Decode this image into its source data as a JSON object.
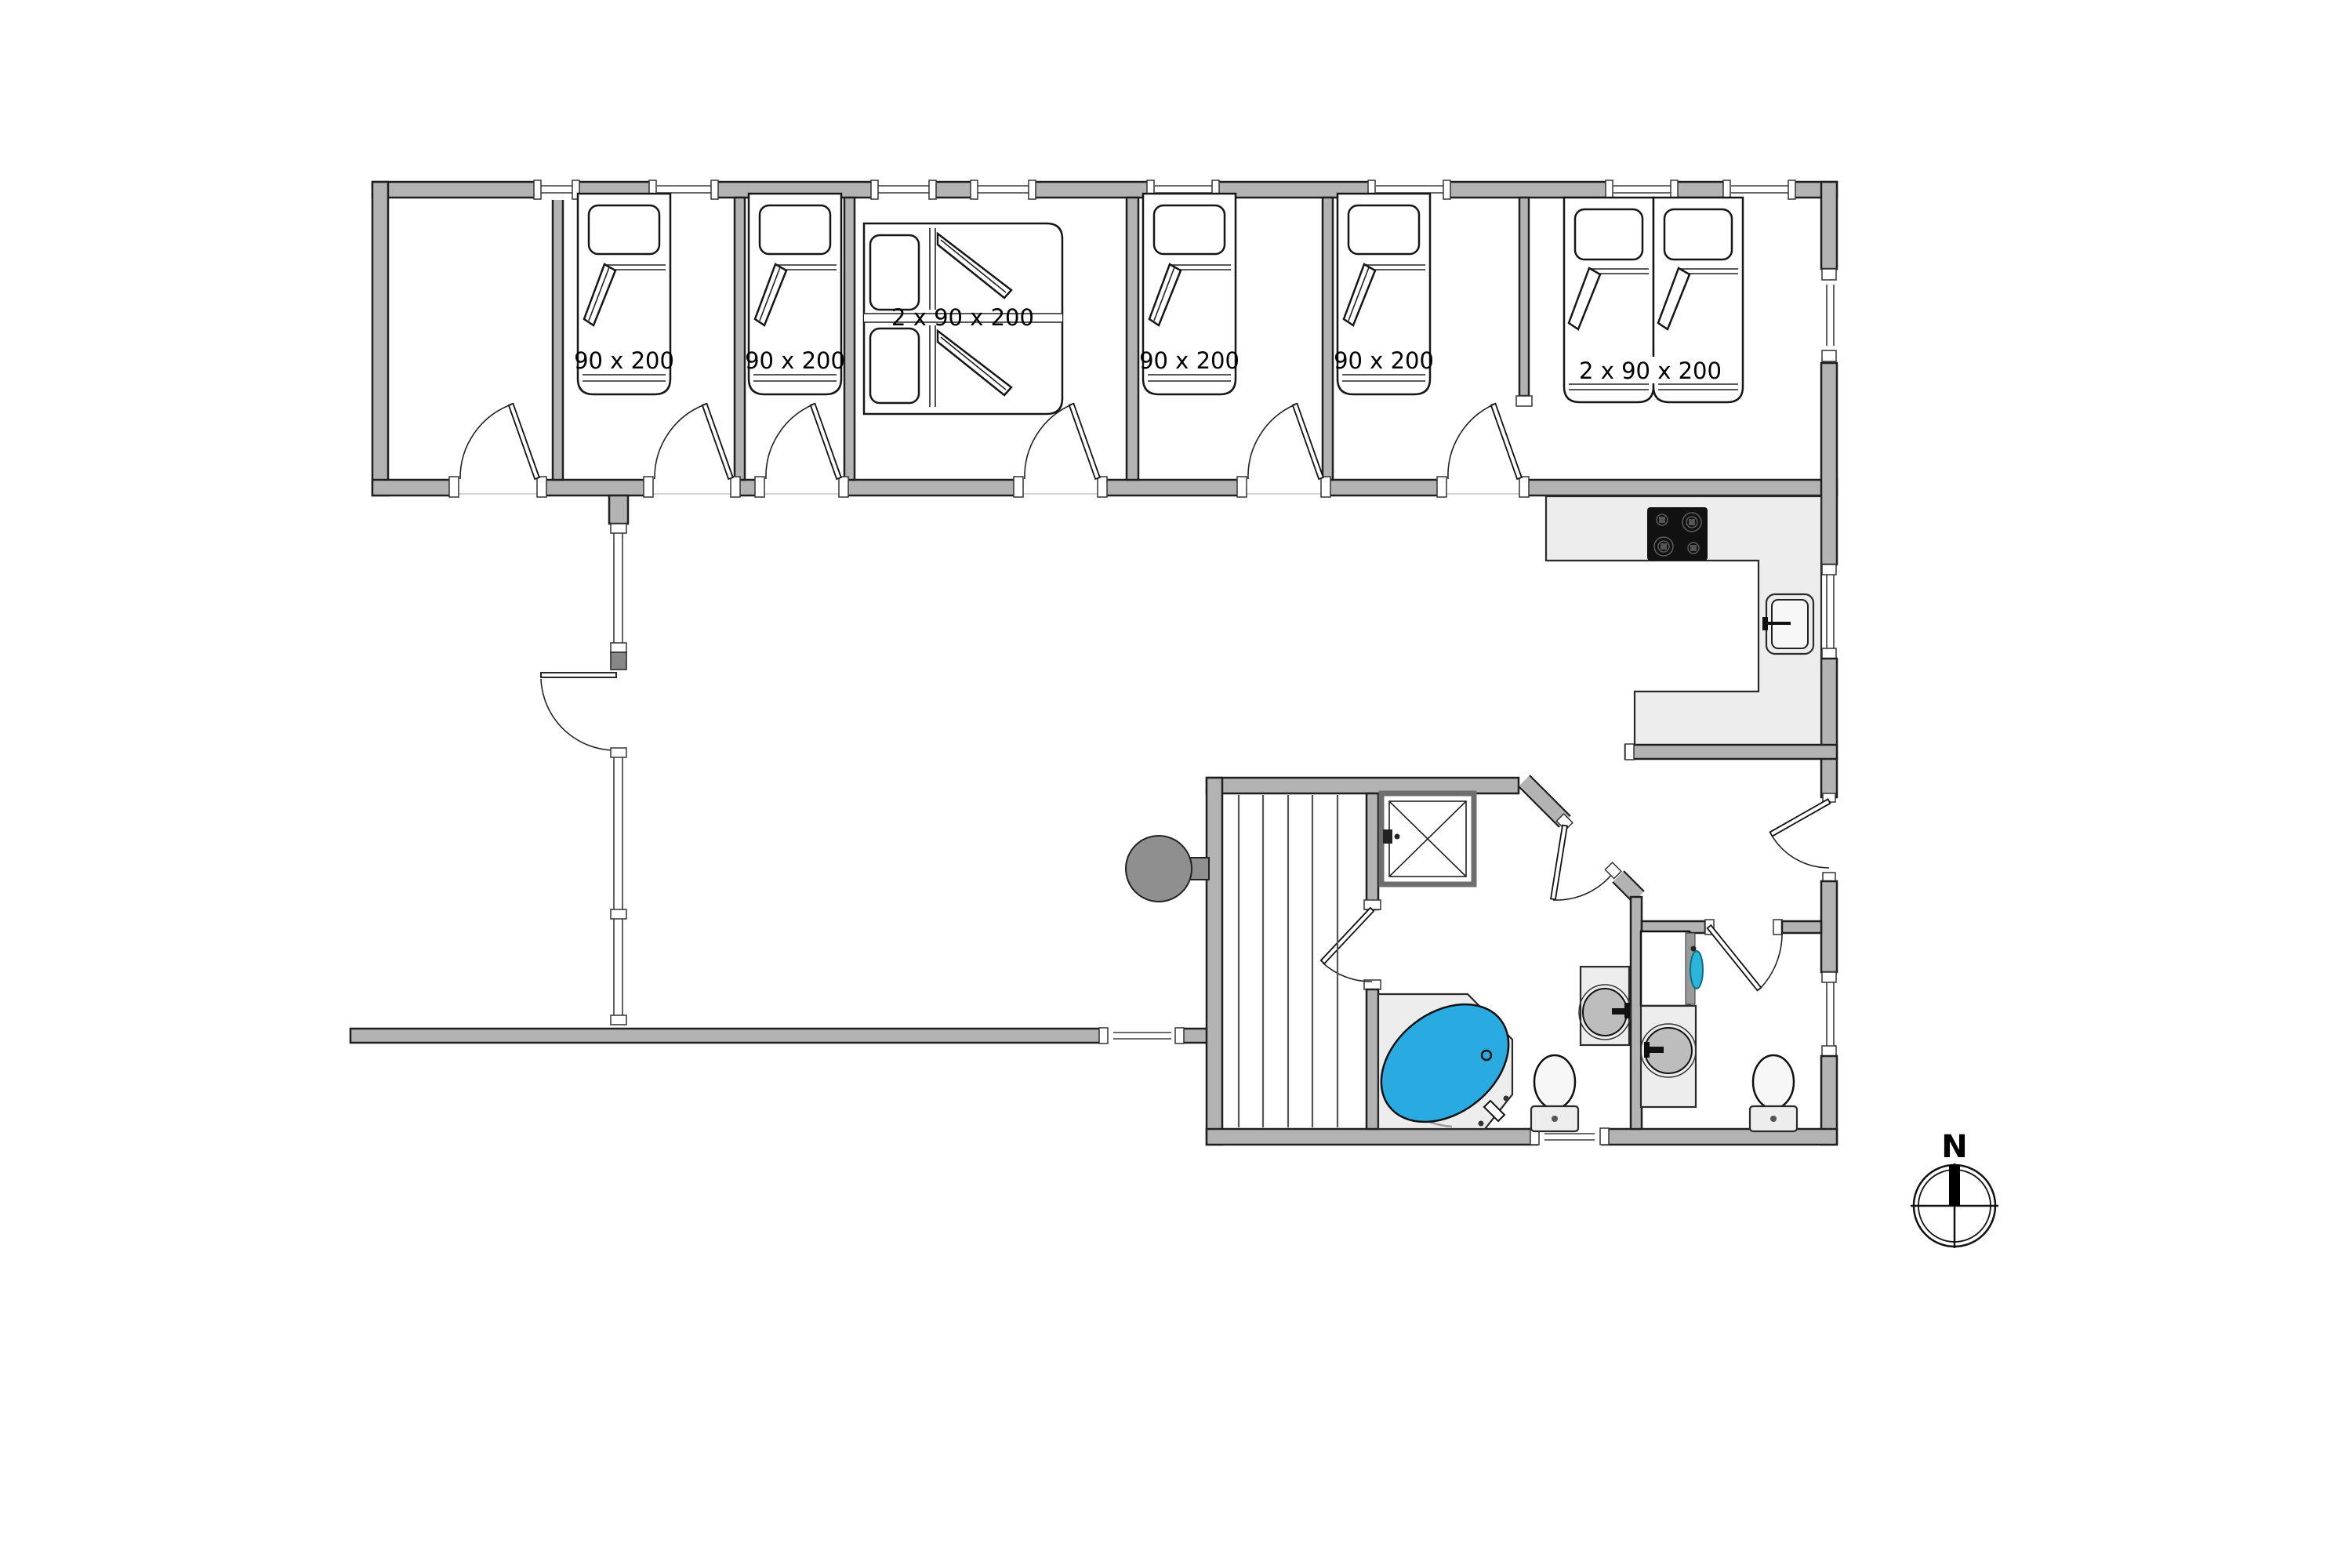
{
  "beds": {
    "singles": [
      "90 x 200",
      "90 x 200",
      "90 x 200",
      "90 x 200"
    ],
    "doubles": [
      "2 x 90 x 200",
      "2 x 90 x 200"
    ]
  },
  "compass": {
    "north_label": "N"
  },
  "colors": {
    "wall_gray": "#b3b3b3",
    "tub_blue": "#29abe2",
    "cooktop_black": "#111111",
    "washer_accent": "#2bb5d8",
    "heater_gray": "#8f8f8f",
    "counter_gray": "#ededed"
  }
}
